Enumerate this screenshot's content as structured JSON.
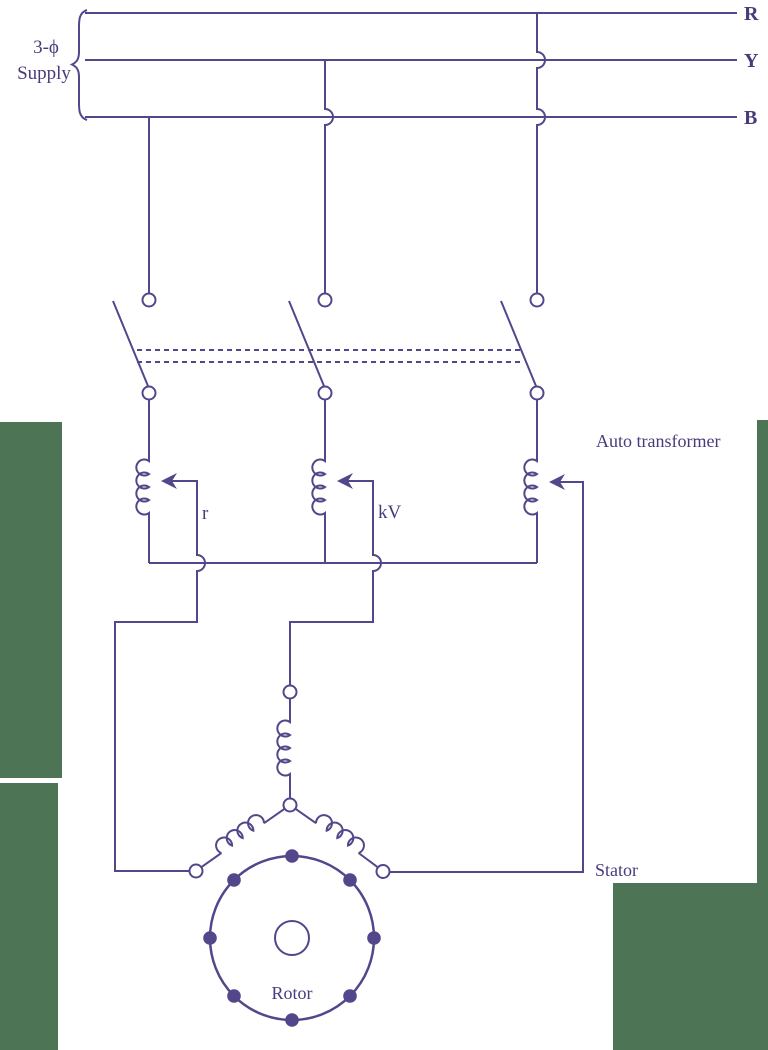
{
  "labels": {
    "supply_prefix": "3-ϕ",
    "supply_word": "Supply",
    "phase_r": "R",
    "phase_y": "Y",
    "phase_b": "B",
    "tap_resistance": "r",
    "tap_voltage": "kV",
    "autotransformer": "Auto transformer",
    "stator": "Stator",
    "rotor": "Rotor"
  },
  "colors": {
    "wire": "#54468a",
    "text": "#4a3a7c",
    "terminal_fill": "#ffffff",
    "panel_green": "#4d7455"
  }
}
